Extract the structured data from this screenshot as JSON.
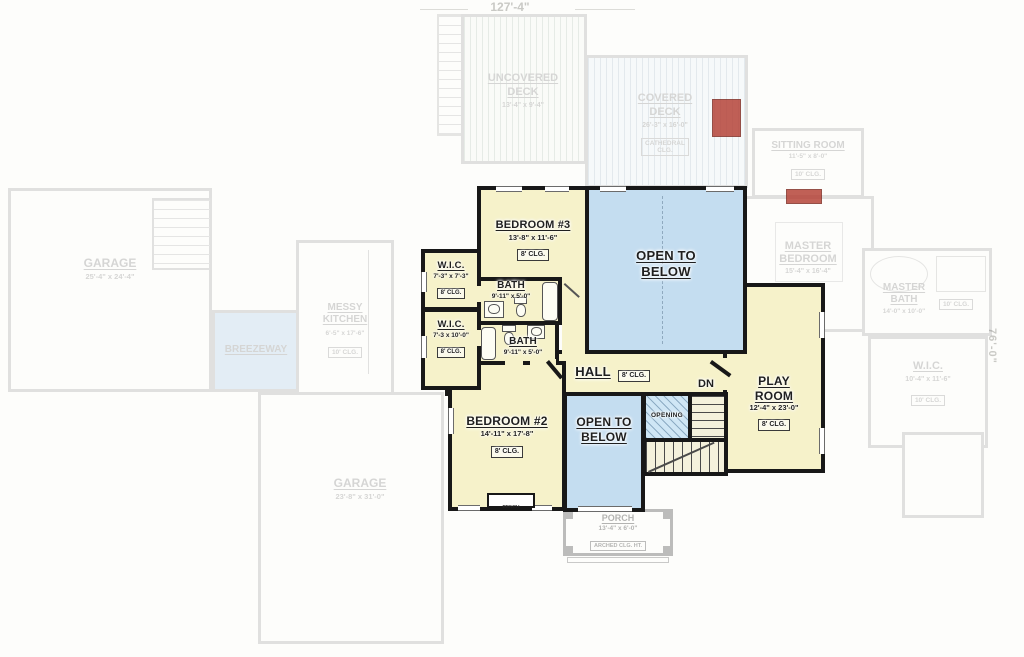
{
  "dimensions": {
    "width_top": "127'-4\"",
    "height_right": "76'-0\""
  },
  "upper_floor": {
    "bedroom3": {
      "name": "BEDROOM #3",
      "dims": "13'-8\" x 11'-6\"",
      "ceiling": "8' CLG."
    },
    "open_to_below_main": {
      "line1": "OPEN TO",
      "line2": "BELOW"
    },
    "wic_upper": {
      "name": "W.I.C.",
      "dims": "7'-3\" x 7'-3\"",
      "ceiling": "8' CLG."
    },
    "bath_upper": {
      "name": "BATH",
      "dims": "9'-11\" x 5'-0\""
    },
    "wic_lower": {
      "name": "W.I.C.",
      "dims": "7'-3 x 10'-0\"",
      "ceiling": "8' CLG."
    },
    "bath_lower": {
      "name": "BATH",
      "dims": "9'-11\" x 5'-0\""
    },
    "hall": {
      "name": "HALL",
      "ceiling": "8' CLG."
    },
    "bedroom2": {
      "name": "BEDROOM #2",
      "dims": "14'-11\" x 17'-8\"",
      "ceiling": "8' CLG.",
      "bench": "BENCH"
    },
    "open_to_below_stair": {
      "line1": "OPEN TO",
      "line2": "BELOW"
    },
    "opening": {
      "name": "OPENING"
    },
    "stairs": {
      "down": "DN"
    },
    "playroom": {
      "name1": "PLAY",
      "name2": "ROOM",
      "dims": "12'-4\" x 23'-0\"",
      "ceiling": "8' CLG."
    }
  },
  "main_floor": {
    "garage_left": {
      "name": "GARAGE",
      "dims": "25'-4\" x 24'-4\""
    },
    "breezeway": {
      "name": "BREEZEWAY"
    },
    "messy_kitchen": {
      "name1": "MESSY",
      "name2": "KITCHEN",
      "dims": "6'-5\" x 17'-6\"",
      "ceiling": "10' CLG."
    },
    "garage_bottom": {
      "name": "GARAGE",
      "dims": "23'-8\" x 31'-0\""
    },
    "uncovered_deck": {
      "name1": "UNCOVERED",
      "name2": "DECK",
      "dims": "13'-4\" x 9'-4\""
    },
    "covered_deck": {
      "name1": "COVERED",
      "name2": "DECK",
      "dims": "26'-3\" x 16'-0\"",
      "ceiling1": "CATHEDRAL",
      "ceiling2": "CLG."
    },
    "sitting_room": {
      "name": "SITTING ROOM",
      "dims": "11'-5\" x 8'-0\"",
      "ceiling": "10' CLG."
    },
    "master_bedroom": {
      "name1": "MASTER",
      "name2": "BEDROOM",
      "dims": "15'-4\" x 16'-4\""
    },
    "master_bath": {
      "name1": "MASTER",
      "name2": "BATH",
      "dims": "14'-0\" x 10'-0\"",
      "ceiling": "10' CLG."
    },
    "wic_master": {
      "name": "W.I.C.",
      "dims": "10'-4\" x 11'-6\"",
      "ceiling": "10' CLG."
    },
    "porch": {
      "name": "PORCH",
      "dims": "13'-4\" x 6'-0\"",
      "ceiling": "ARCHED CLG. HT."
    }
  },
  "colors": {
    "room_yellow": "#f6f2ca",
    "open_blue": "#c4ddf0",
    "wall": "#181818",
    "accent_red": "#b2392e"
  }
}
